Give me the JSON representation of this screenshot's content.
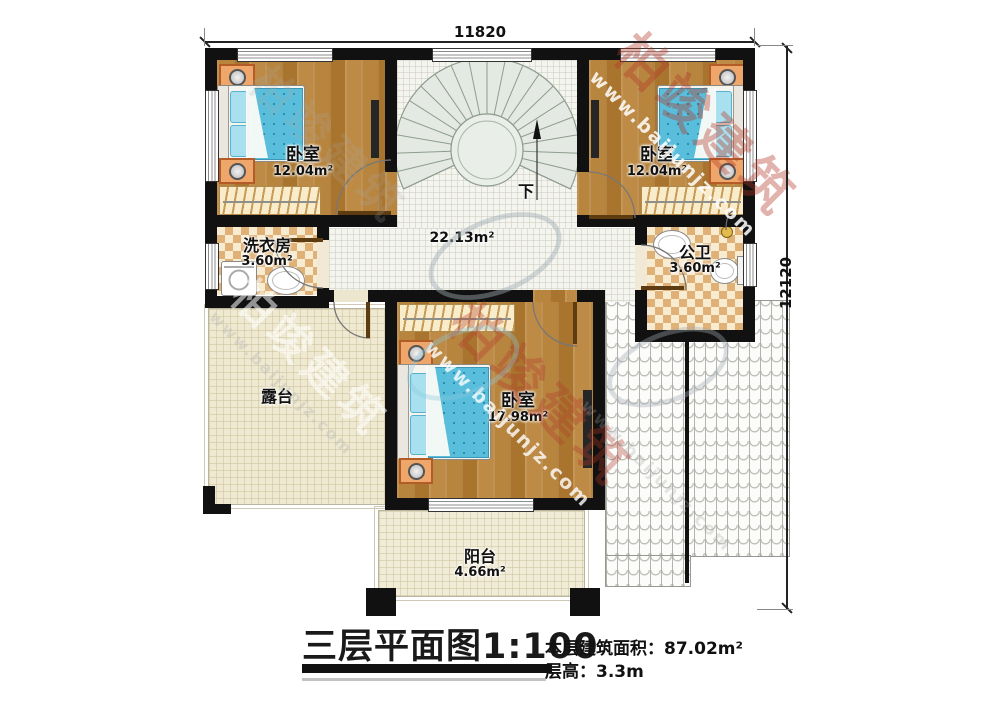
{
  "dimensions": {
    "top": "11820",
    "right": "12120"
  },
  "rooms": {
    "bedroom_tl": {
      "name": "卧室",
      "area": "12.04m²"
    },
    "bedroom_tr": {
      "name": "卧室",
      "area": "12.04m²"
    },
    "bedroom_b": {
      "name": "卧室",
      "area": "17.98m²"
    },
    "laundry": {
      "name": "洗衣房",
      "area": "3.60m²"
    },
    "bathroom": {
      "name": "公卫",
      "area": "3.60m²"
    },
    "hall": {
      "area": "22.13m²"
    },
    "terrace": {
      "name": "露台"
    },
    "balcony": {
      "name": "阳台",
      "area": "4.66m²"
    }
  },
  "stairs": {
    "direction_label": "下"
  },
  "footer": {
    "title": "三层平面图",
    "scale": "1:100",
    "area_label": "本层建筑面积：",
    "area_value": "87.02m²",
    "height_label": "层高：",
    "height_value": "3.3m"
  },
  "watermark": {
    "brand": "柏竣建筑",
    "url": "www.baijunjz.com"
  },
  "colors": {
    "wall": "#111111",
    "wood": "#b2803c",
    "tile": "#f4f4ee",
    "checker_dark": "#e0b176",
    "stair": "#e4eae3",
    "terrace": "#efe9d2",
    "bed_blue": "#58bedb",
    "watermark_red": "#b8432f"
  }
}
